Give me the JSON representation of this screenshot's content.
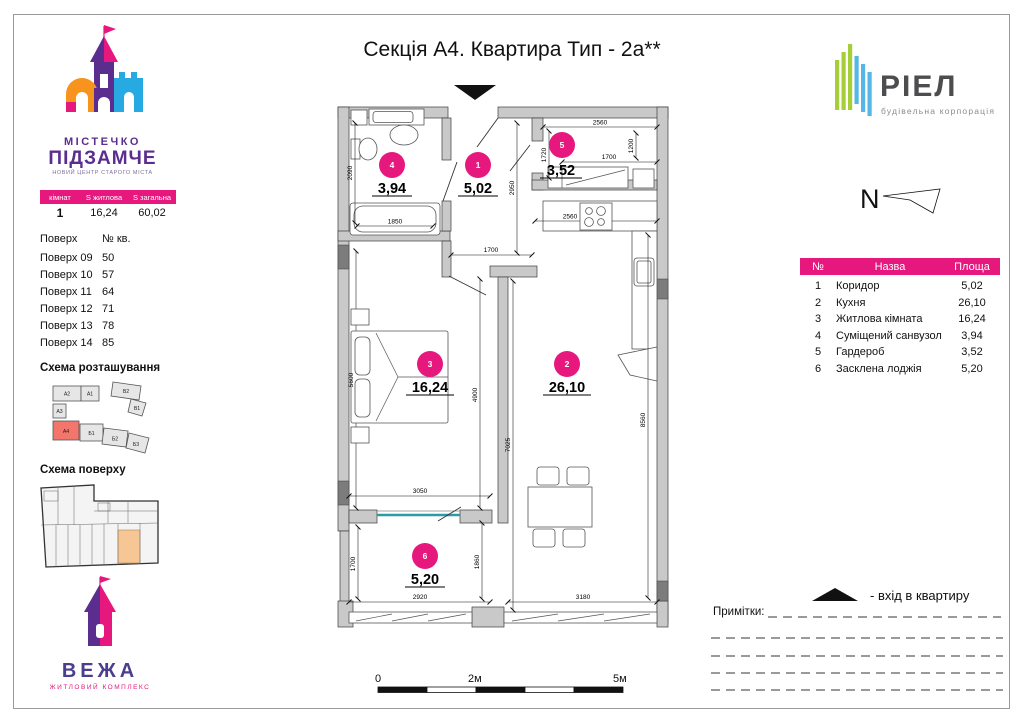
{
  "title": "Секція А4. Квартира Тип - 2а**",
  "brand": {
    "town_logo": {
      "line1": "МІСТЕЧКО",
      "line2": "ПІДЗАМЧЕ",
      "tagline": "НОВИЙ ЦЕНТР СТАРОГО МІСТА"
    },
    "tower_logo": {
      "name": "ВЕЖА",
      "tagline": "ЖИТЛОВИЙ КОМПЛЕКС"
    },
    "riel_logo": {
      "name": "РІЕЛ",
      "tagline": "будівельна корпорація"
    }
  },
  "summary_table": {
    "headers": [
      "кімнат",
      "S житлова",
      "S загальна"
    ],
    "values": [
      "1",
      "16,24",
      "60,02"
    ]
  },
  "floors_table": {
    "headers": [
      "Поверх",
      "№ кв."
    ],
    "rows": [
      {
        "floor": "Поверх 09",
        "apt": "50"
      },
      {
        "floor": "Поверх 10",
        "apt": "57"
      },
      {
        "floor": "Поверх 11",
        "apt": "64"
      },
      {
        "floor": "Поверх 12",
        "apt": "71"
      },
      {
        "floor": "Поверх 13",
        "apt": "78"
      },
      {
        "floor": "Поверх 14",
        "apt": "85"
      }
    ]
  },
  "site_schema": {
    "title": "Схема розташування",
    "blocks": [
      "А2",
      "А1",
      "В2",
      "В1",
      "А3",
      "А4",
      "Б1",
      "Б2",
      "Б3"
    ],
    "highlighted": "А4"
  },
  "floor_schema": {
    "title": "Схема поверху"
  },
  "north": {
    "label": "N"
  },
  "rooms_table": {
    "headers": [
      "№",
      "Назва",
      "Площа"
    ],
    "rows": [
      {
        "num": "1",
        "name": "Коридор",
        "area": "5,02"
      },
      {
        "num": "2",
        "name": "Кухня",
        "area": "26,10"
      },
      {
        "num": "3",
        "name": "Житлова кімната",
        "area": "16,24"
      },
      {
        "num": "4",
        "name": "Суміщений санвузол",
        "area": "3,94"
      },
      {
        "num": "5",
        "name": "Гардероб",
        "area": "3,52"
      },
      {
        "num": "6",
        "name": "Засклена лоджія",
        "area": "5,20"
      }
    ]
  },
  "plan": {
    "rooms": [
      {
        "num": "1",
        "area": "5,02"
      },
      {
        "num": "2",
        "area": "26,10"
      },
      {
        "num": "3",
        "area": "16,24"
      },
      {
        "num": "4",
        "area": "3,94"
      },
      {
        "num": "5",
        "area": "3,52"
      },
      {
        "num": "6",
        "area": "5,20"
      }
    ],
    "dims": {
      "d2090": "2090",
      "d1850": "1850",
      "d1700c": "1700",
      "d2950": "2950",
      "d2560t": "2560",
      "d1720": "1720",
      "d1200": "1200",
      "d1700g": "1700",
      "d2560k": "2560",
      "d5600": "5600",
      "d4900": "4900",
      "d7025": "7025",
      "d8560": "8560",
      "d3050": "3050",
      "d1700l": "1700",
      "d1860": "1860",
      "d2920": "2920",
      "d3180": "3180"
    }
  },
  "legend": {
    "entrance_text": "-  вхід в квартиру",
    "notes_label": "Примітки:"
  },
  "scale_bar": {
    "start": "0",
    "mid": "2м",
    "end": "5м"
  },
  "colors": {
    "magenta": "#E6187E",
    "purple": "#5B2D8E",
    "orange": "#F7941E",
    "blue": "#27AAE1",
    "green": "#A6CE39",
    "riel_gray": "#4D4D4F",
    "wall": "#C9C9C9",
    "wall_dark": "#7C7C7C",
    "site_highlight": "#F2766B",
    "floor_highlight": "#F6C795"
  }
}
